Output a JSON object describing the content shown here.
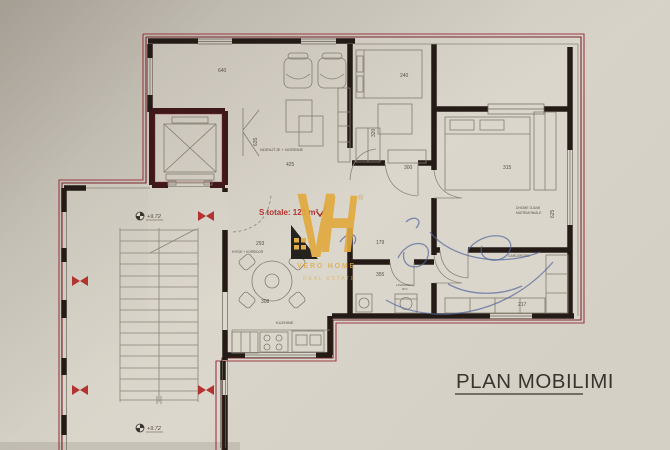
{
  "document": {
    "type_label": "PLAN MOBILIMI",
    "area_note": "S totale: 123 m²"
  },
  "watermark": {
    "letter_v": "V",
    "letter_h": "H",
    "registered": "®",
    "brand": "VERO HOME",
    "tagline": "REAL ESTATE",
    "gold_color": "#e1aa3f"
  },
  "rooms": {
    "living_label": "NDENJTJE + NGRENIE",
    "hall_label": "HYRJE + KORRIDOR",
    "kitchen_label": "KUZHINE",
    "master_label_line1": "DHOME GJUMI",
    "master_label_line2": "MATRIMONIALE",
    "garderobe_label": "GARDEROBE",
    "laundry_label_line1": "LAVANDERI",
    "laundry_label_line2": "W.C."
  },
  "dimensions": {
    "living_top": "640",
    "living_width": "425",
    "living_height": "635",
    "bed_width": "240",
    "bedroom_width": "300",
    "bedroom_height": "320",
    "master_width": "315",
    "master_height": "625",
    "hall_width": "293",
    "table_width": "308",
    "corridor_width": "179",
    "corridor_length": "355",
    "garderobe_width": "217"
  },
  "stairs": {
    "elevation_top": "+9.72",
    "elevation_bottom": "+9.72"
  },
  "colors": {
    "paper": "#d8d4ca",
    "wall": "#241b17",
    "plan_border_red": "#8c2e36",
    "pencil_blue": "#54679c",
    "note_red": "#b23330"
  }
}
